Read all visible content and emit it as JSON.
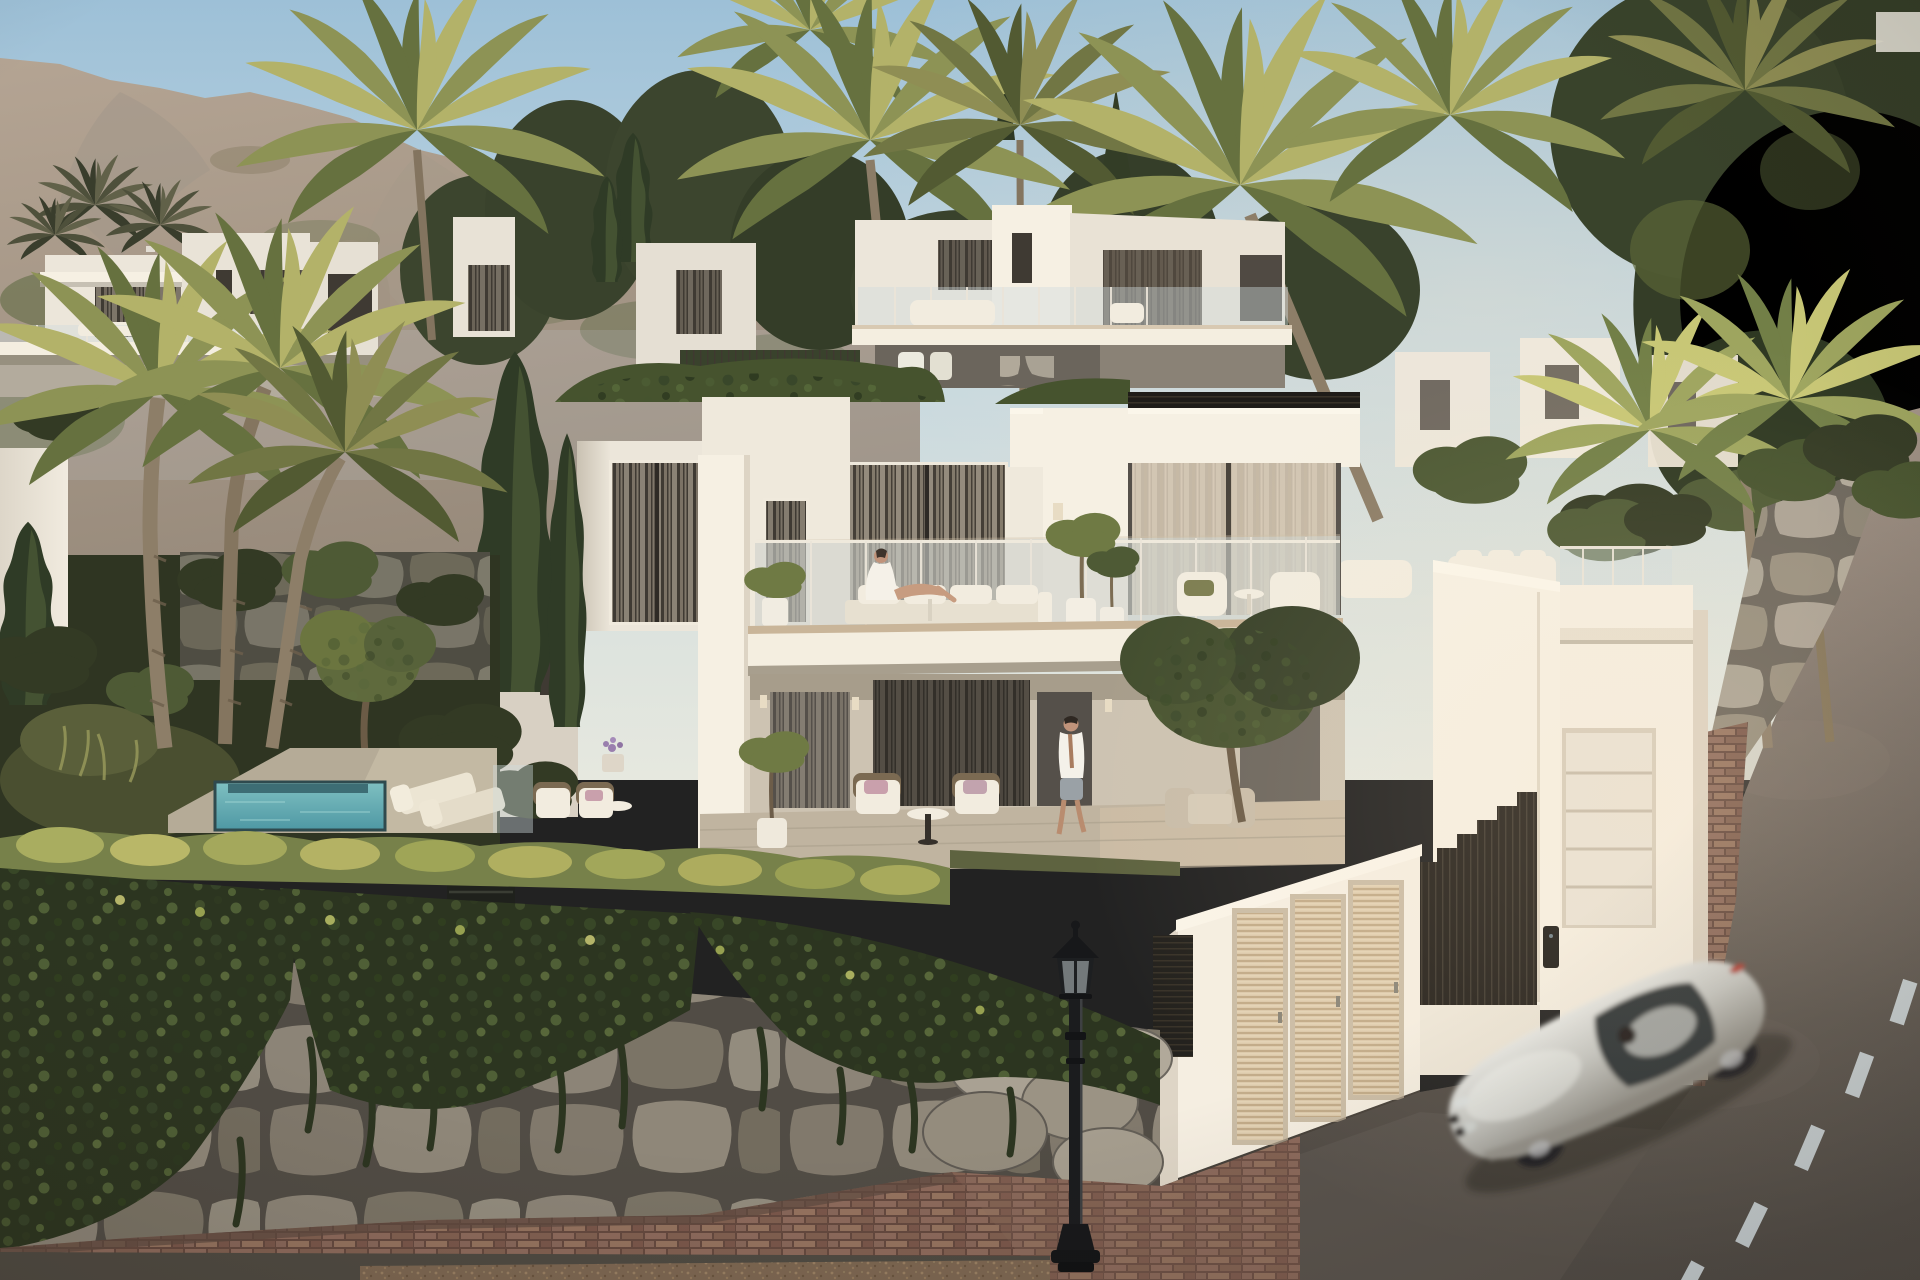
{
  "scene": {
    "type": "architectural-exterior-render",
    "time_of_day": "golden-hour",
    "people_count": 2,
    "objects": [
      "rocky mountain ridge",
      "terraced white modern villas",
      "date palm trees",
      "cypress trees",
      "main two-storey villa",
      "upper terrace with glass balustrade",
      "woman in white robe reclining on terrace sofa",
      "lower covered terrace with wicker armchairs",
      "man in open white shirt walking on terrace",
      "plunge pool with stone deck",
      "sun loungers",
      "ivy-covered stone retaining wall",
      "bright trimmed hedge",
      "white entrance wall with three louvered doors",
      "black slatted fence",
      "intercom panel",
      "garage with white sectional door",
      "brick paved walkway and driveway",
      "curving asphalt road with dashed lane markings",
      "silver sports coupe in motion",
      "black classic street lamp"
    ]
  },
  "palette": {
    "sky_top": "#9dc0d7",
    "sky_mid": "#c2d7e2",
    "sky_horizon": "#e6e8df",
    "sun_glow": "#ffe3ba",
    "mountain_lit": "#b4a493",
    "mountain_shade": "#96897a",
    "mountain_scrub": "#6f7452",
    "tree_dark": "#333c26",
    "tree_mid": "#4e5a35",
    "palm_lit": "#b3b269",
    "palm_mid": "#8d9355",
    "palm_dark": "#66713f",
    "palm_trunk": "#8b7c67",
    "villa_white": "#ece6da",
    "villa_bright": "#f6f0e3",
    "villa_shade": "#d8d0c3",
    "window_dark": "#3f3a33",
    "curtain_light": "#d9cdb9",
    "glass_tint": "#cfdbdd",
    "deck_trim": "#c9b599",
    "terrace_floor": "#c0b4a0",
    "hedge_lit": "#a9ad60",
    "hedge_mid": "#77814a",
    "ivy_dark": "#2c3520",
    "stone_light": "#a9a294",
    "stone_joint": "#6b655c",
    "pool_light": "#7fc0c1",
    "pool_deep": "#4e98a4",
    "gate_wall": "#f5eee1",
    "louver_door": "#dcc9ab",
    "fence_dark": "#26221d",
    "garage_door": "#e9e2d5",
    "brick_light": "#8d6a5c",
    "brick_joint": "#65493f",
    "road_light": "#a39488",
    "road_dark": "#524d48",
    "lane_dash": "#ccd5d9",
    "car_silver": "#c9cac6",
    "car_glass": "#2e3438",
    "car_tail": "#b44238",
    "lamp_black": "#1b1c1e",
    "skin": "#c0937a",
    "fabric_white": "#f2ecdf",
    "pillow_pink": "#c9a0ac"
  }
}
